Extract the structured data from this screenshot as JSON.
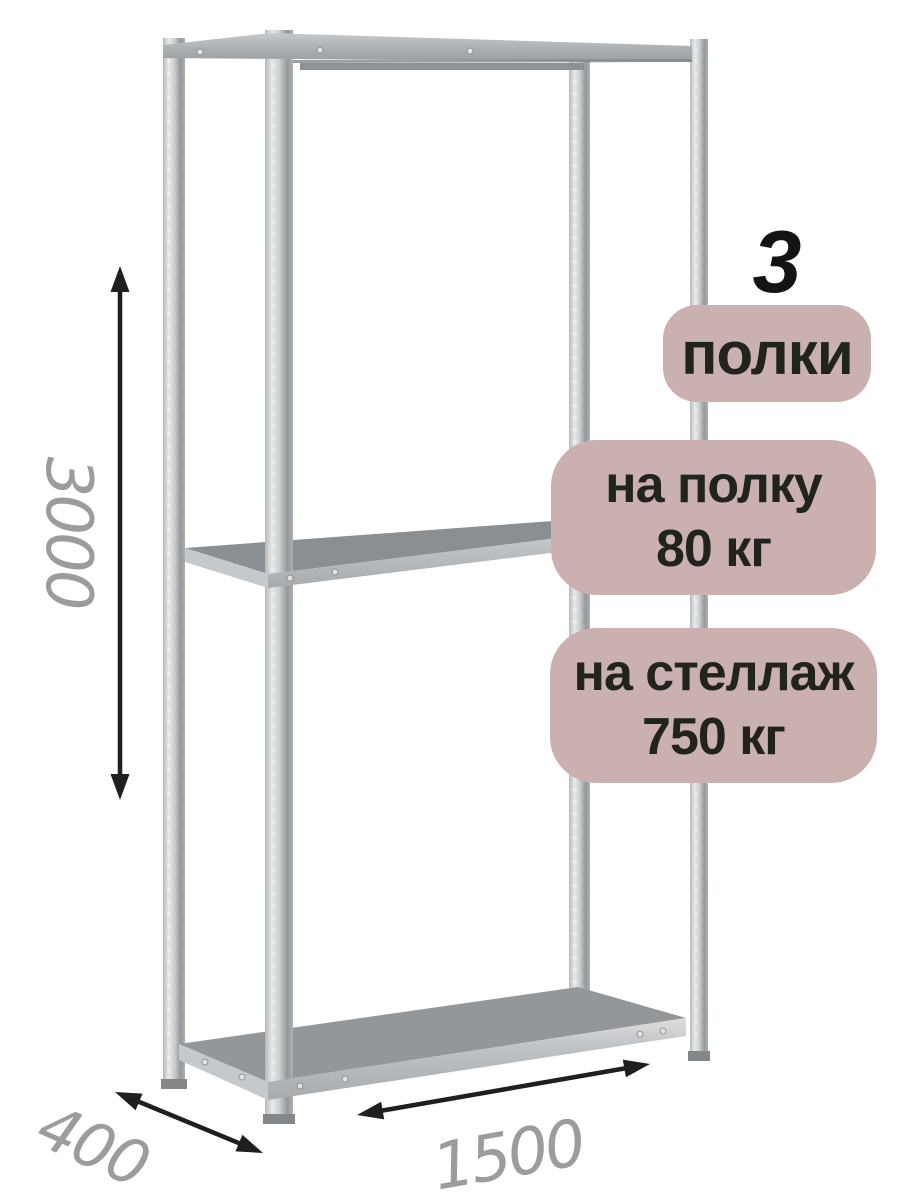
{
  "product_illustration": {
    "subject": "metal-shelving-rack",
    "shelf_count_visible": 3
  },
  "dimensions": {
    "height": "3000",
    "depth": "400",
    "width": "1500"
  },
  "badges": {
    "shelf_count": "3",
    "shelf_count_label": "полки",
    "shelf_load_line1": "на полку",
    "shelf_load_line2": "80 кг",
    "rack_load_line1": "на стеллаж",
    "rack_load_line2": "750 кг"
  },
  "icons": {
    "height_arrow": "double-headed-vertical-arrow",
    "depth_arrow": "double-headed-diagonal-arrow",
    "width_arrow": "double-headed-diagonal-arrow"
  },
  "colors": {
    "badge_bg": "#cbb0b0",
    "badge_text": "#20241c",
    "dimension_text": "#9c9c9c",
    "arrow": "#1f1f1f",
    "metal_light": "#e6e8e9",
    "metal_dark": "#95989b",
    "shelf_top_middle": "#8a8f93",
    "shelf_top_bottom": "#94979a",
    "shelf_face": "#bdc0c3"
  }
}
